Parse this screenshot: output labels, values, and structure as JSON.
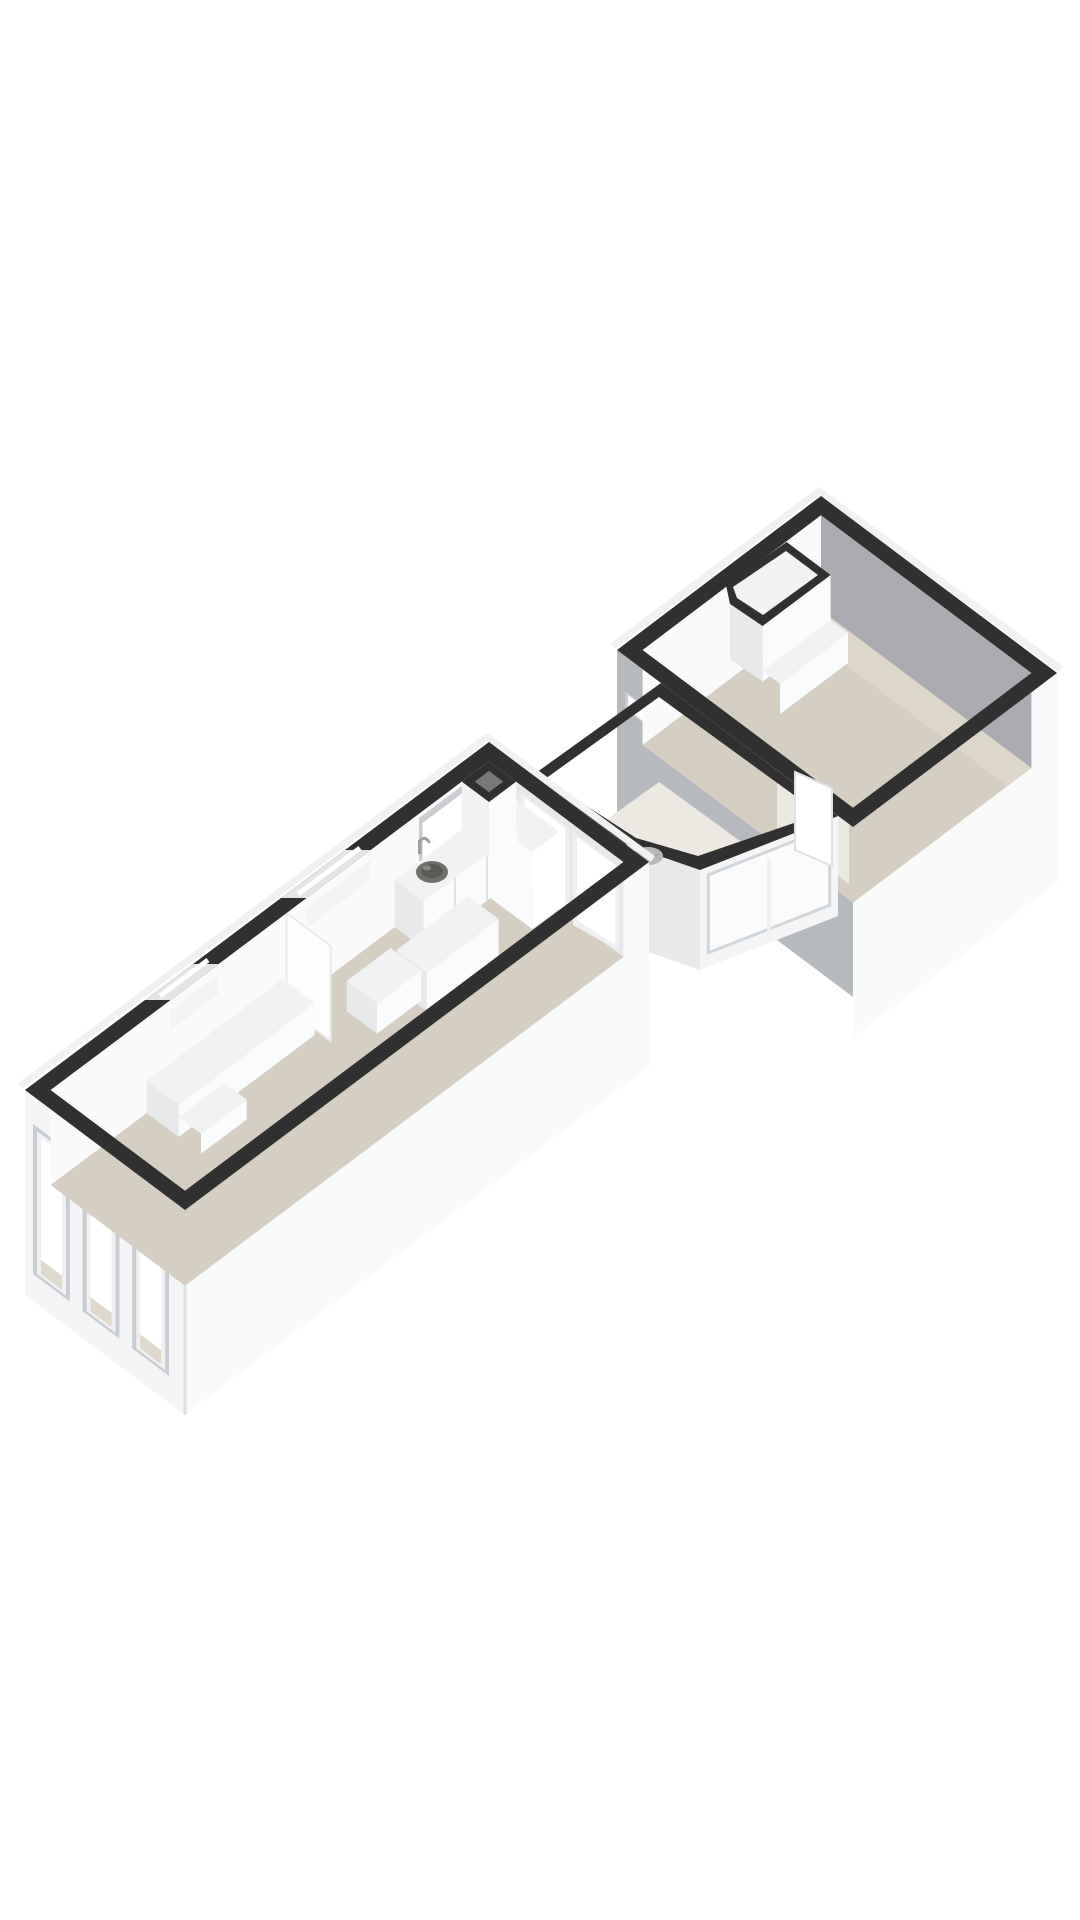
{
  "page": {
    "background": "#ffffff",
    "kind": "3d-floorplan-render",
    "orientation": "isometric"
  },
  "palette": {
    "band": "#303030",
    "bandEdgeHighlight": "#f1f1f2",
    "wallLit": "#fafafa",
    "wallLitShade": "#f3f4f5",
    "wallSoft": "#e6e8ea",
    "wallGrayInner": "#aaacb1",
    "wallGrayOuter": "#b6b9bd",
    "outerWhite": "#f9fafa",
    "outerFront": "#f4f5f6",
    "outerSliver": "#eff0f2",
    "floor": "#d5cec2",
    "floorLight": "#ded8cd",
    "vestibuleFloor": "#ece9e3",
    "openingGlow": "#e8e4dc",
    "glass": "#ffffff",
    "glassSoft": "#fafbfc",
    "frame": "#eef0f1",
    "reveal": "#c9ccd0",
    "slotGap": "#e2e4e6",
    "boxTop": "#f1f2f3",
    "boxFront": "#fafbfc",
    "boxSide": "#e7e9ea",
    "panel": "#fdfdfe",
    "ductHollow": "#77787a",
    "sink": "#716f69",
    "sinkInner": "#5b5954",
    "metal": "#9aa0a4",
    "mat": "#b9b8b2",
    "doorLeaf": "#ffffff",
    "edgeLine": "#dfe1e3"
  },
  "scene": {
    "rooms": [
      {
        "id": "main-room",
        "shape": "long-rectangle",
        "floor": "beige",
        "features": [
          "kitchen-counter",
          "sink",
          "faucet",
          "tall-corner-cabinet",
          "island-cabinet",
          "low-bench",
          "wall-panel",
          "duct-column",
          "three-front-windows",
          "two-slot-windows",
          "tall-wall-window",
          "two-french-doors"
        ]
      },
      {
        "id": "entry-vestibule",
        "shape": "angled-bay",
        "floor": "light",
        "features": [
          "glazed-door-panel",
          "door-mat"
        ]
      },
      {
        "id": "upper-room",
        "shape": "rectangle",
        "floor": "beige",
        "features": [
          "corner-closet",
          "doorway",
          "open-door",
          "small-high-window",
          "wall-opening"
        ]
      }
    ],
    "style": {
      "wallTops": "dark",
      "exteriorWalls": "white",
      "shadedInteriorWalls": "gray"
    }
  }
}
